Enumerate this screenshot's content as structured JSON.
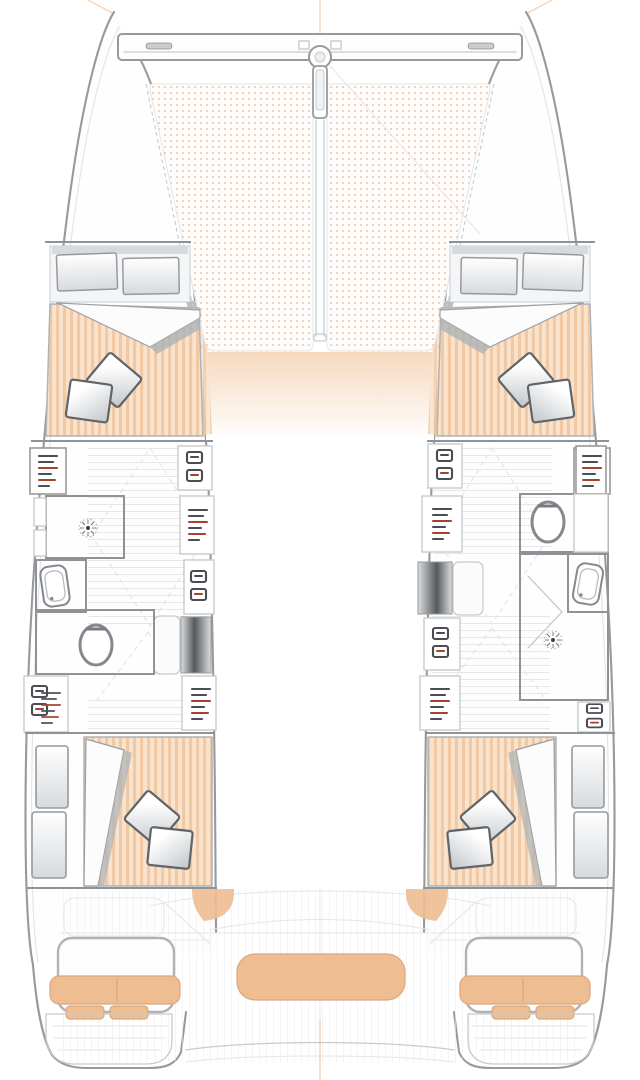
{
  "page": {
    "title": "Catamaran lower-deck floor plan (4 cabins / 2 heads), bow up, no visible text labels",
    "background": "#ffffff",
    "canvas": {
      "width": 640,
      "height": 1080
    }
  },
  "colors": {
    "page-bg": "#ffffff",
    "white": "#ffffff",
    "hull-body": "#fefefe",
    "hull-outline": "#97999c",
    "line-light": "#c7cbce",
    "line-faint": "#e3e6e8",
    "wall": "#8f9397",
    "fixture": "#85898d",
    "mattress-light": "#f9e3cd",
    "mattress-stripe": "#f1c9a5",
    "tramp-bg": "#fffdfb",
    "tramp-dot": "#eec3ab",
    "cushion": "#eebd92",
    "cushion-deep": "#dca77e",
    "pillow-hi": "#ffffff",
    "pillow-lo": "#c2c6c9",
    "pillow-edge": "#606468",
    "blanket": "#fcfcfd",
    "blanket-edge": "#9aa0a5",
    "shadow": "#aeb3b7",
    "steps-dark": "#55595c",
    "steps-mid": "#9ea2a5",
    "steps-light": "#dcdee0",
    "red-mark": "#a8402f",
    "dark-mark": "#4a4e52",
    "peach-fade": "#f6d9be",
    "plank": "#e7eaec",
    "panel-band": "#f4f5f6",
    "panel-shade": "#d7dadd",
    "rig-orange": "#f2c6a4"
  },
  "legend": {
    "orientation": "bow-up",
    "regions": [
      {
        "id": "trampoline",
        "desc": "bow trampoline net, two dotted panels split by bowsprit"
      },
      {
        "id": "crossbeam",
        "desc": "forward crossbeam with central forestay fitting"
      },
      {
        "id": "bowsprit",
        "desc": "center bowsprit pole running aft through trampoline"
      },
      {
        "id": "forward-cabin-port",
        "desc": "double berth, striped mattress, 2 pillows, folded blanket, headboard shelves"
      },
      {
        "id": "forward-cabin-starboard",
        "desc": "mirror of port forward cabin"
      },
      {
        "id": "midship-port",
        "desc": "head with shower, sink, toilet; corridor; companionway steps; lockers"
      },
      {
        "id": "midship-starboard",
        "desc": "head with toilet forward, sink, shower aft; corridor; companionway steps; lockers"
      },
      {
        "id": "aft-cabin-port",
        "desc": "double berth, striped mattress, 2 pillows, folded blanket, side lockers"
      },
      {
        "id": "aft-cabin-starboard",
        "desc": "mirror of port aft cabin"
      },
      {
        "id": "stern-area",
        "desc": "cockpit outlines, tan seat cushions, central bench, swim platforms with steps"
      }
    ],
    "fixture_counts": {
      "cabins": 4,
      "heads": 2,
      "showers": 2,
      "sinks": 2,
      "toilets": 2,
      "companionway_steps": 2,
      "pillows": 8
    }
  }
}
